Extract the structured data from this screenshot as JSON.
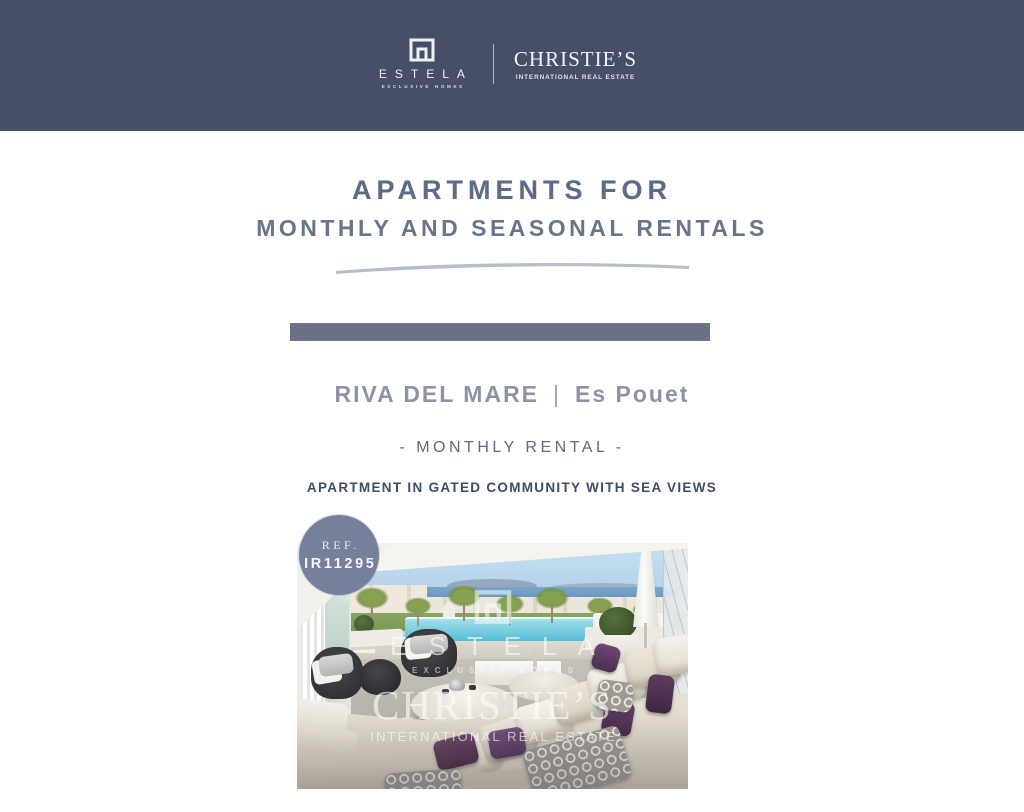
{
  "theme": {
    "header_bg": "#474f68",
    "accent_bar": "#6b7186",
    "title_color": "#5e6b85",
    "swoosh_color": "#b7bdcb",
    "property_title_color": "#8b93a5",
    "badge_bg": "#717b97"
  },
  "header": {
    "estela_name": "ESTELA",
    "estela_tagline": "EXCLUSIVE HOMES",
    "christies_name": "CHRISTIE’S",
    "christies_tagline": "INTERNATIONAL REAL ESTATE"
  },
  "hero": {
    "title_line1": "APARTMENTS FOR",
    "title_line2": "MONTHLY AND SEASONAL RENTALS"
  },
  "listing": {
    "property_name": "RIVA DEL MARE",
    "separator": "|",
    "location": "Es Pouet",
    "rental_type": "- MONTHLY RENTAL -",
    "headline": "APARTMENT IN GATED COMMUNITY WITH SEA VIEWS",
    "ref_label": "REF.",
    "ref_number": "IR11295"
  },
  "photo": {
    "watermark": {
      "estela_name": "ESTELA",
      "estela_tagline": "EXCLUSIVE HOMES",
      "christies_name": "CHRISTIE’S",
      "christies_tagline": "INTERNATIONAL REAL ESTATE"
    }
  }
}
